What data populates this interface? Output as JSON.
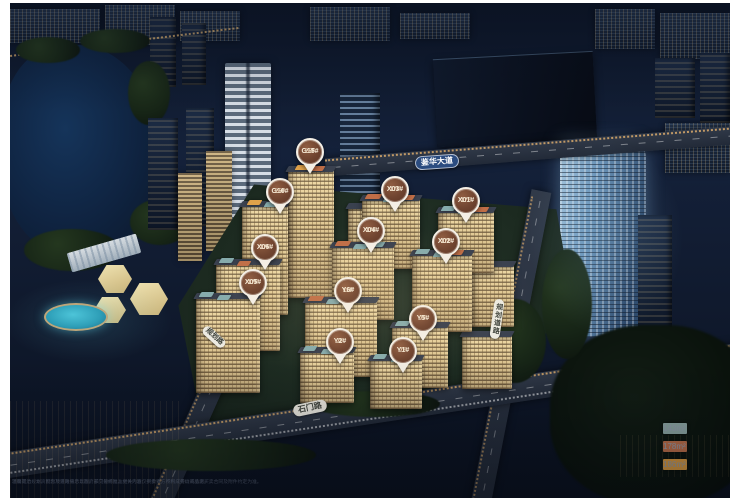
{
  "scene": {
    "description": "night aerial rendering of residential development masterplan",
    "accent_colors": {
      "pin_brown": "#6f432f",
      "pin_ring": "#f4efe6",
      "road_sign_blue": "#2b4c80"
    }
  },
  "pins": [
    {
      "id": "G15#",
      "floors": "25F",
      "x": 300,
      "y": 149
    },
    {
      "id": "G10#",
      "floors": "25F",
      "x": 270,
      "y": 189
    },
    {
      "id": "X03#",
      "floors": "17F",
      "x": 385,
      "y": 187
    },
    {
      "id": "X01#",
      "floors": "17F",
      "x": 456,
      "y": 198
    },
    {
      "id": "X04#",
      "floors": "17F",
      "x": 361,
      "y": 228
    },
    {
      "id": "X02#",
      "floors": "17F",
      "x": 436,
      "y": 239
    },
    {
      "id": "X06#",
      "floors": "17F",
      "x": 255,
      "y": 245
    },
    {
      "id": "X05#",
      "floors": "17F",
      "x": 243,
      "y": 280
    },
    {
      "id": "Y6#",
      "floors": "11F",
      "x": 338,
      "y": 288
    },
    {
      "id": "Y5#",
      "floors": "7F",
      "x": 413,
      "y": 316
    },
    {
      "id": "Y2#",
      "floors": "7F",
      "x": 330,
      "y": 339
    },
    {
      "id": "Y1#",
      "floors": "7F",
      "x": 393,
      "y": 348
    }
  ],
  "road_labels": [
    {
      "text": "鉴华大道",
      "x": 427,
      "y": 159,
      "rot": -4,
      "style": "blue",
      "vertical": false,
      "small": false
    },
    {
      "text": "石门路",
      "x": 300,
      "y": 405,
      "rot": -12,
      "style": "white",
      "vertical": false,
      "small": false
    },
    {
      "text": "规划路",
      "x": 204,
      "y": 334,
      "rot": 42,
      "style": "white",
      "vertical": false,
      "small": true
    },
    {
      "text": "规划道路",
      "x": 487,
      "y": 316,
      "rot": 8,
      "style": "white",
      "vertical": true,
      "small": true
    }
  ],
  "legend": {
    "items": [
      {
        "area": "143m²",
        "color": "#8fa9a6"
      },
      {
        "area": "178m²",
        "color": "#c0714b"
      },
      {
        "area": "186m²",
        "color": "#e09f42"
      }
    ]
  },
  "roof_tag_colors": {
    "teal": "#86abac",
    "terracotta": "#c06e47",
    "amber": "#e0a24a"
  },
  "roof_tags": [
    [
      286,
      162,
      14,
      "amber"
    ],
    [
      302,
      163,
      12,
      "terracotta"
    ],
    [
      238,
      197,
      13,
      "amber"
    ],
    [
      255,
      199,
      12,
      "teal"
    ],
    [
      356,
      191,
      15,
      "terracotta"
    ],
    [
      374,
      194,
      13,
      "teal"
    ],
    [
      392,
      192,
      12,
      "terracotta"
    ],
    [
      432,
      203,
      13,
      "teal"
    ],
    [
      449,
      206,
      12,
      "teal"
    ],
    [
      466,
      204,
      12,
      "terracotta"
    ],
    [
      326,
      238,
      14,
      "terracotta"
    ],
    [
      344,
      241,
      13,
      "teal"
    ],
    [
      362,
      239,
      12,
      "teal"
    ],
    [
      406,
      246,
      13,
      "teal"
    ],
    [
      424,
      249,
      12,
      "teal"
    ],
    [
      441,
      247,
      12,
      "terracotta"
    ],
    [
      210,
      255,
      13,
      "teal"
    ],
    [
      228,
      258,
      12,
      "terracotta"
    ],
    [
      190,
      289,
      13,
      "teal"
    ],
    [
      208,
      292,
      12,
      "teal"
    ],
    [
      299,
      293,
      14,
      "terracotta"
    ],
    [
      317,
      296,
      13,
      "teal"
    ],
    [
      335,
      294,
      12,
      "teal"
    ],
    [
      386,
      318,
      13,
      "teal"
    ],
    [
      404,
      321,
      12,
      "teal"
    ],
    [
      294,
      343,
      12,
      "teal"
    ],
    [
      312,
      346,
      12,
      "teal"
    ],
    [
      364,
      351,
      12,
      "teal"
    ],
    [
      382,
      354,
      12,
      "teal"
    ]
  ],
  "disclaimer": {
    "line1": "温馨提示：本资料为项目效果示意图，非交付标准，相关内容仅供参考，不构成要约或承诺。",
    "line2": "项目周边规划、配套及道路信息以政府部门最终批准文件为准，买卖双方权利义务以商品房买卖合同及附件约定为准。"
  }
}
